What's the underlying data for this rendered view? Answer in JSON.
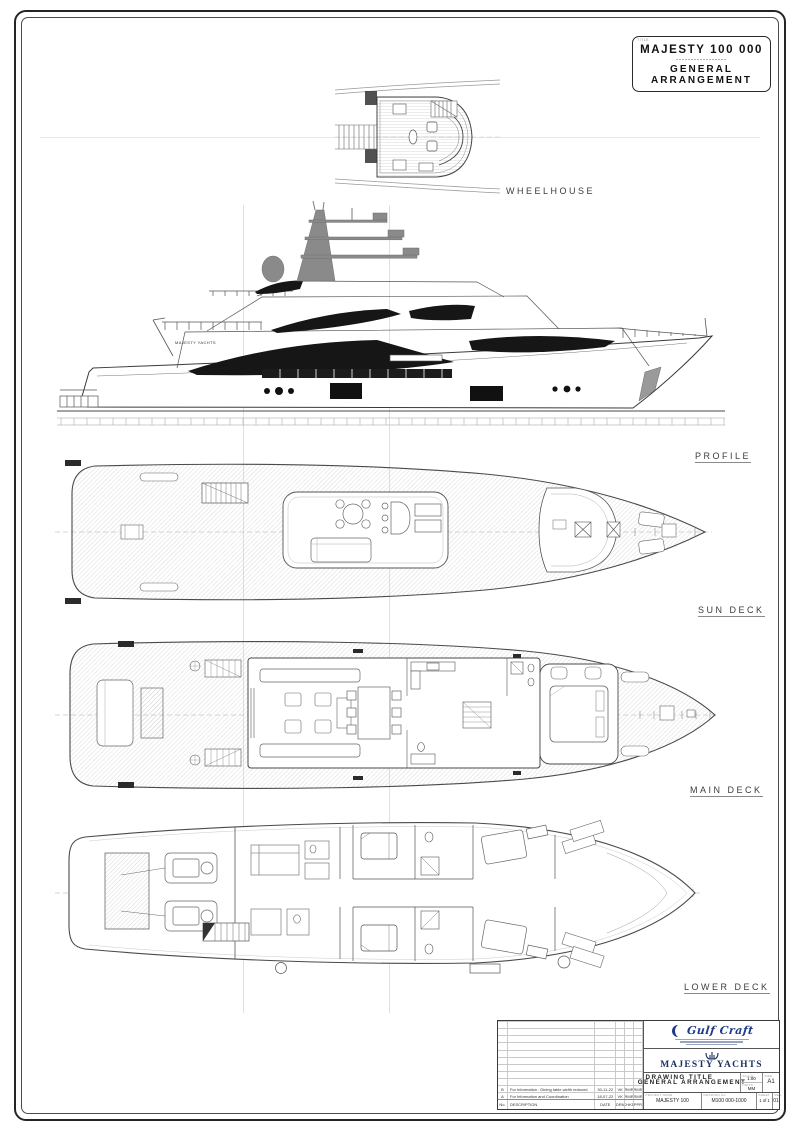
{
  "sheet": {
    "title_box": {
      "tag": "TITLE",
      "model": "MAJESTY 100 000",
      "dashes": "-----------------",
      "title_line1": "GENERAL",
      "title_line2": "ARRANGEMENT"
    },
    "view_labels": {
      "wheelhouse": "WHEELHOUSE",
      "profile": "PROFILE",
      "sun_deck": "SUN DECK",
      "main_deck": "MAIN DECK",
      "lower_deck": "LOWER DECK"
    },
    "profile_hull_text": "MAJESTY YACHTS"
  },
  "title_block": {
    "logo_name": "Gulf Craft",
    "brand": "MAJESTY YACHTS",
    "drawing_title": "GENERAL ARRANGEMENT",
    "fields": {
      "title_label": "DRAWING TITLE",
      "scale_label": "SCALE",
      "scale": "1:80",
      "units_label": "UNITS",
      "units": "MM",
      "size_label": "SIZE",
      "size": "A1",
      "project_label": "PROJECT NAME",
      "project": "MAJESTY 100",
      "drawing_no_label": "DRAWING No.",
      "drawing_no": "M100 000-1000",
      "sheet_label": "SHEET",
      "sheet": "1 of 1",
      "rev_label": "REV.",
      "rev": "01"
    },
    "rev_table": {
      "headers": {
        "no": "No.",
        "description": "DESCRIPTION",
        "date": "DATE",
        "drn": "DRN",
        "chkd": "CHKD",
        "apprd": "APPRD"
      },
      "empty_rows": 9,
      "rows": [
        {
          "no": "B",
          "description": "For Information : Dining table width reduced",
          "date": "30-11-22",
          "drn": "VK",
          "chkd": "RMR",
          "apprd": "RMR"
        },
        {
          "no": "A",
          "description": "For Information and Coordination",
          "date": "18-07-22",
          "drn": "VK",
          "chkd": "RMR",
          "apprd": "RMR"
        }
      ]
    }
  }
}
